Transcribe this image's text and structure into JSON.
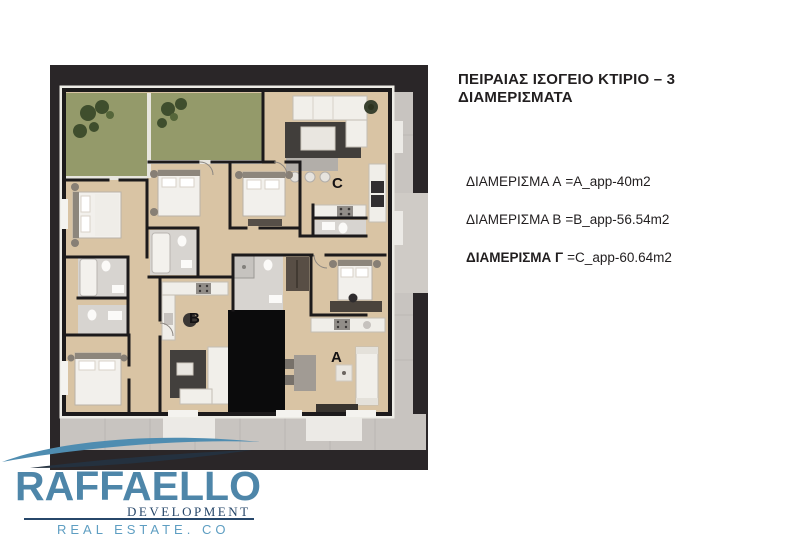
{
  "title": "ΠΕΙΡΑΙΑΣ ΙΣΟΓΕΙΟ ΚΤΙΡΙΟ – 3 ΔΙΑΜΕΡΙΣΜΑΤΑ",
  "apartments": [
    {
      "label": "ΔΙΑΜΕΡΙΣΜΑ A",
      "value": "=A_app-40m2"
    },
    {
      "label": "ΔΙΑΜΕΡΙΣΜΑ B",
      "value": "=B_app-56.54m2"
    },
    {
      "label": "ΔΙΑΜΕΡΙΣΜΑ Γ",
      "value": "=C_app-60.64m2"
    }
  ],
  "floorplan": {
    "units": [
      {
        "letter": "A"
      },
      {
        "letter": "B"
      },
      {
        "letter": "C"
      }
    ],
    "colors": {
      "frame": "#2a2628",
      "floor": "#dcc7a7",
      "garden": "#949a6a",
      "sidewalk": "#c8c4c0",
      "stair_core": "#0b0b0c"
    }
  },
  "logo": {
    "name": "RAFFAELLO",
    "subtitle": "DEVELOPMENT",
    "tagline": "REAL ESTATE. CO",
    "colors": {
      "name_blue": "#4e86a9",
      "navy": "#27476a",
      "light_blue": "#5e9ec2"
    }
  }
}
